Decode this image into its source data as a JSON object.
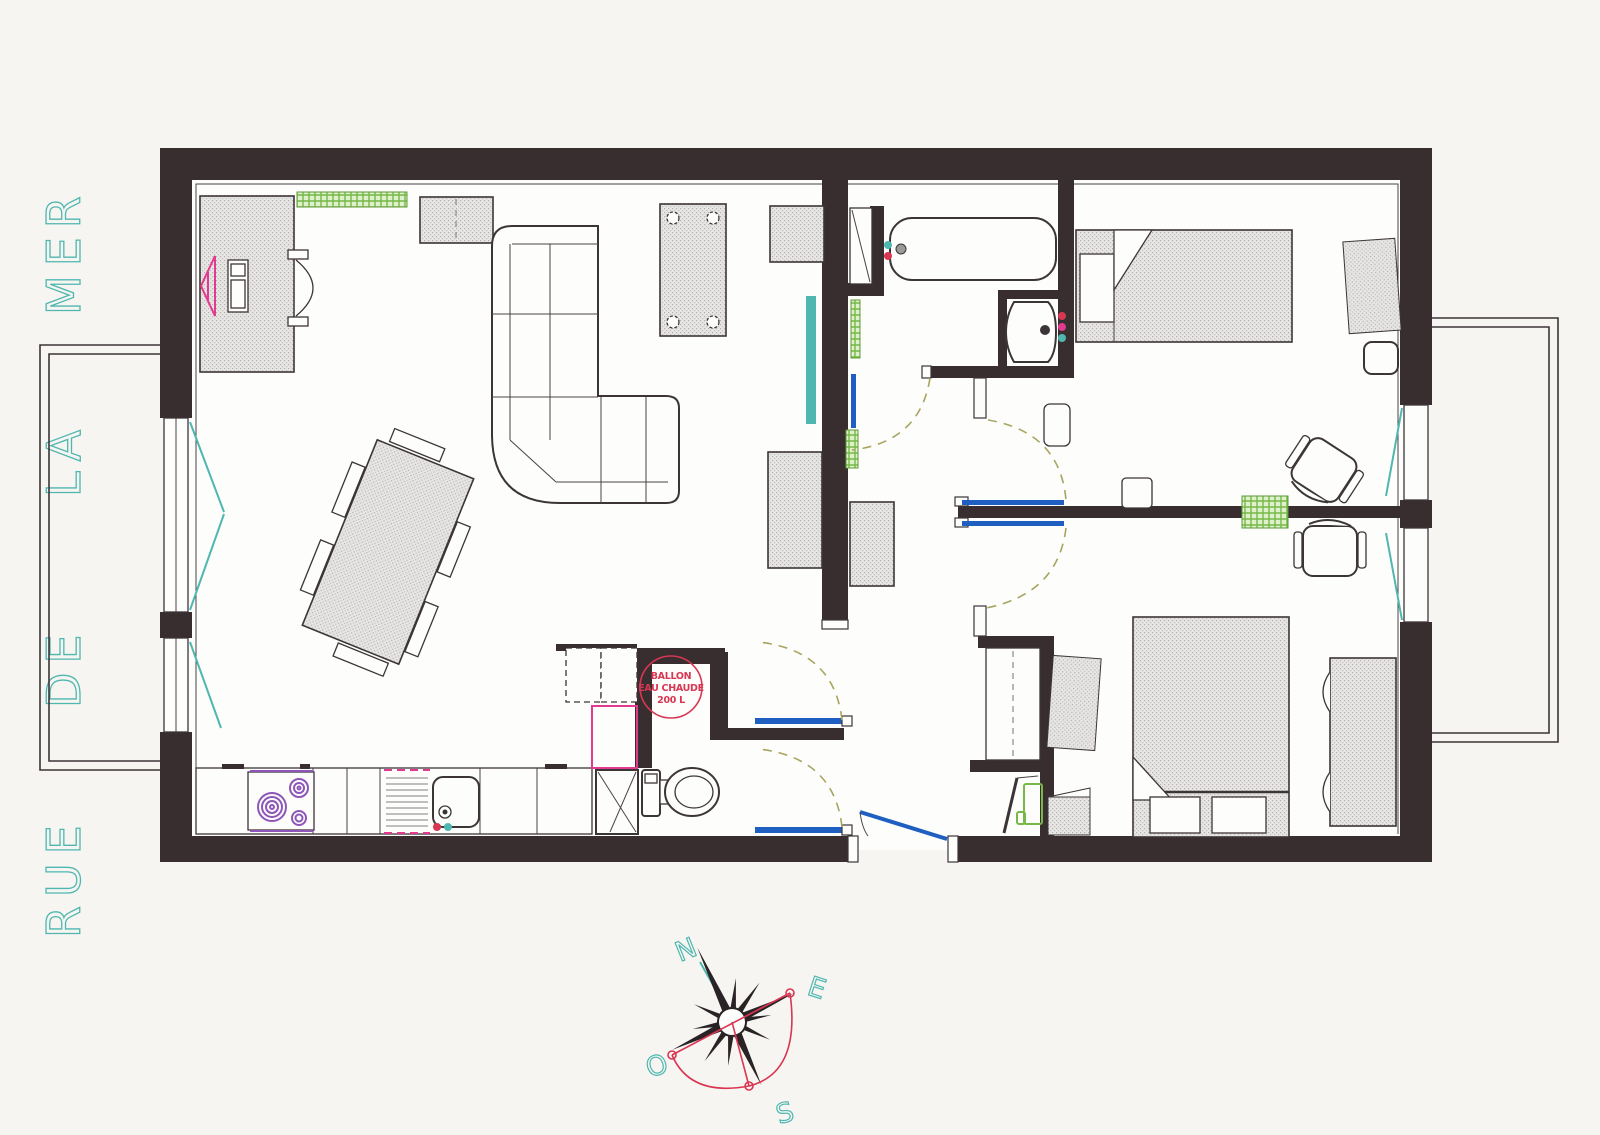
{
  "street_label": {
    "words": [
      "MER",
      "LA",
      "DE",
      "RUE"
    ]
  },
  "water_heater_label": {
    "lines": [
      "BALLON",
      "EAU CHAUDE",
      "200 L"
    ]
  },
  "compass": {
    "north": "N",
    "east": "E",
    "south": "S",
    "west": "O"
  },
  "colors": {
    "wall": "#382e30",
    "teal": "#4fb7b0",
    "blue": "#1f5fc2",
    "olive": "#a8a55e",
    "red": "#d93652",
    "purple": "#8d56b8",
    "pink": "#e23a8e",
    "green": "#76b947",
    "paper": "#f7f5f1"
  }
}
